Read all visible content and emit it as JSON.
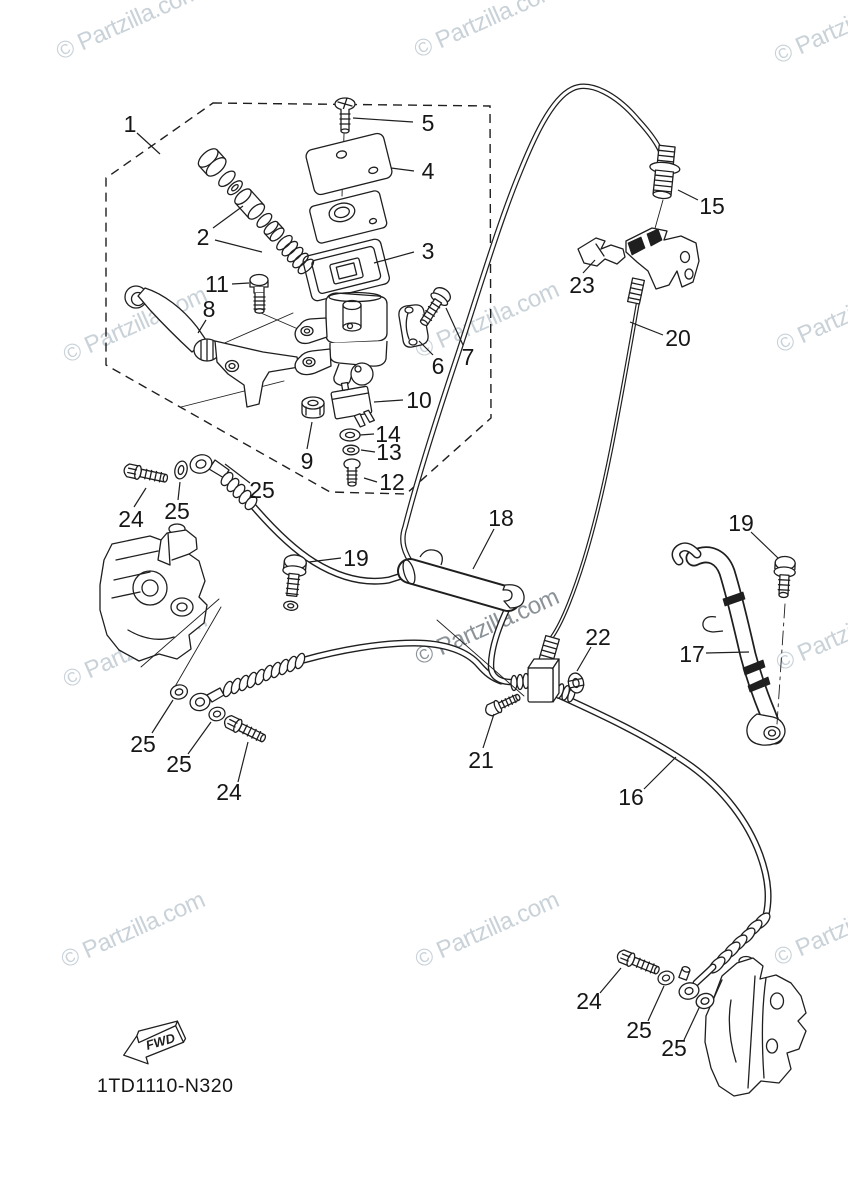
{
  "page": {
    "background_color": "#ffffff",
    "line_color": "#1f1f1f"
  },
  "watermark": {
    "text": "© Partzilla.com",
    "color_light": "#c9d2d8",
    "color_dark": "#8b9298"
  },
  "footer": {
    "diagram_code": "1TD1110-N320",
    "fwd_label": "FWD"
  },
  "callouts": {
    "c1": "1",
    "c2": "2",
    "c3": "3",
    "c4": "4",
    "c5": "5",
    "c6": "6",
    "c7": "7",
    "c8": "8",
    "c9": "9",
    "c10": "10",
    "c11": "11",
    "c12": "12",
    "c13": "13",
    "c14": "14",
    "c15": "15",
    "c16": "16",
    "c17": "17",
    "c18": "18",
    "c19a": "19",
    "c19b": "19",
    "c20": "20",
    "c21": "21",
    "c22": "22",
    "c23": "23",
    "c24a": "24",
    "c24b": "24",
    "c24c": "24",
    "c25a": "25",
    "c25b": "25",
    "c25c": "25",
    "c25d": "25",
    "c25e": "25",
    "c25f": "25"
  }
}
